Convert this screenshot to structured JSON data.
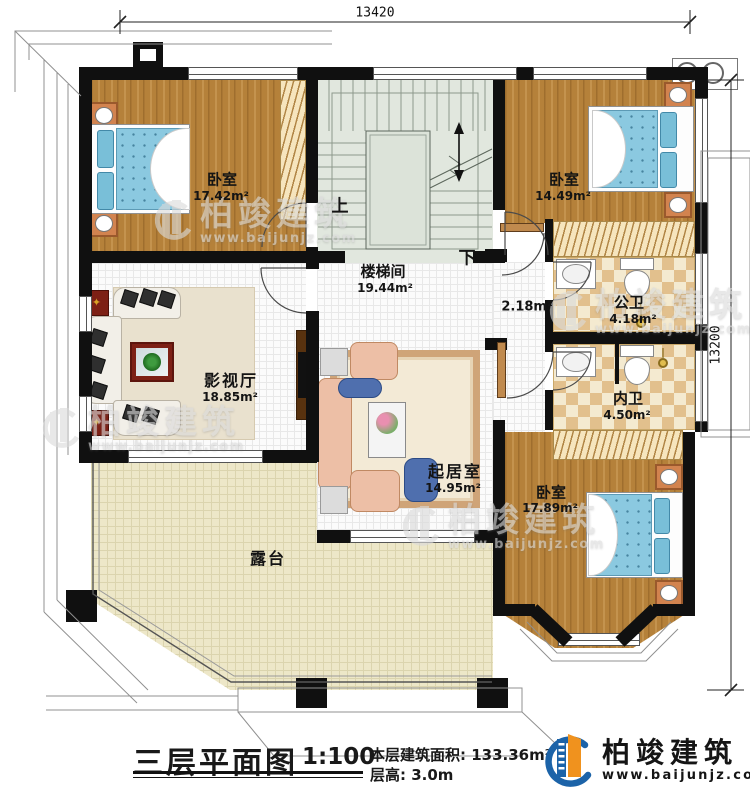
{
  "plan": {
    "dimension_top": "13420",
    "dimension_right": "13200",
    "rooms": {
      "bedroom_top_left": {
        "name": "卧室",
        "area": "17.42m²"
      },
      "bedroom_top_right": {
        "name": "卧室",
        "area": "14.49m²"
      },
      "stairwell": {
        "name": "楼梯间",
        "area": "19.44m²"
      },
      "hallway": {
        "area": "2.18m²"
      },
      "public_bathroom": {
        "name": "公卫",
        "area": "4.18m²"
      },
      "inner_bathroom": {
        "name": "内卫",
        "area": "4.50m²"
      },
      "media_room": {
        "name": "影视厅",
        "area": "18.85m²"
      },
      "living_room": {
        "name": "起居室",
        "area": "14.95m²"
      },
      "bedroom_bottom_right": {
        "name": "卧室",
        "area": "17.89m²"
      },
      "terrace": {
        "name": "露台"
      }
    },
    "stair_up_label": "上",
    "stair_down_label": "下"
  },
  "title_block": {
    "title": "三层平面图",
    "scale": "1:100",
    "floor_area": "本层建筑面积: 133.36m²",
    "floor_height": "层高: 3.0m"
  },
  "brand": {
    "name": "柏竣建筑",
    "website": "www.baijunjz.com"
  },
  "watermark": {
    "name": "柏竣建筑",
    "website": "www.baijunjz.com"
  },
  "colors": {
    "wall": "#101010",
    "brand_blue": "#1c63a8",
    "brand_orange": "#f0921e"
  }
}
